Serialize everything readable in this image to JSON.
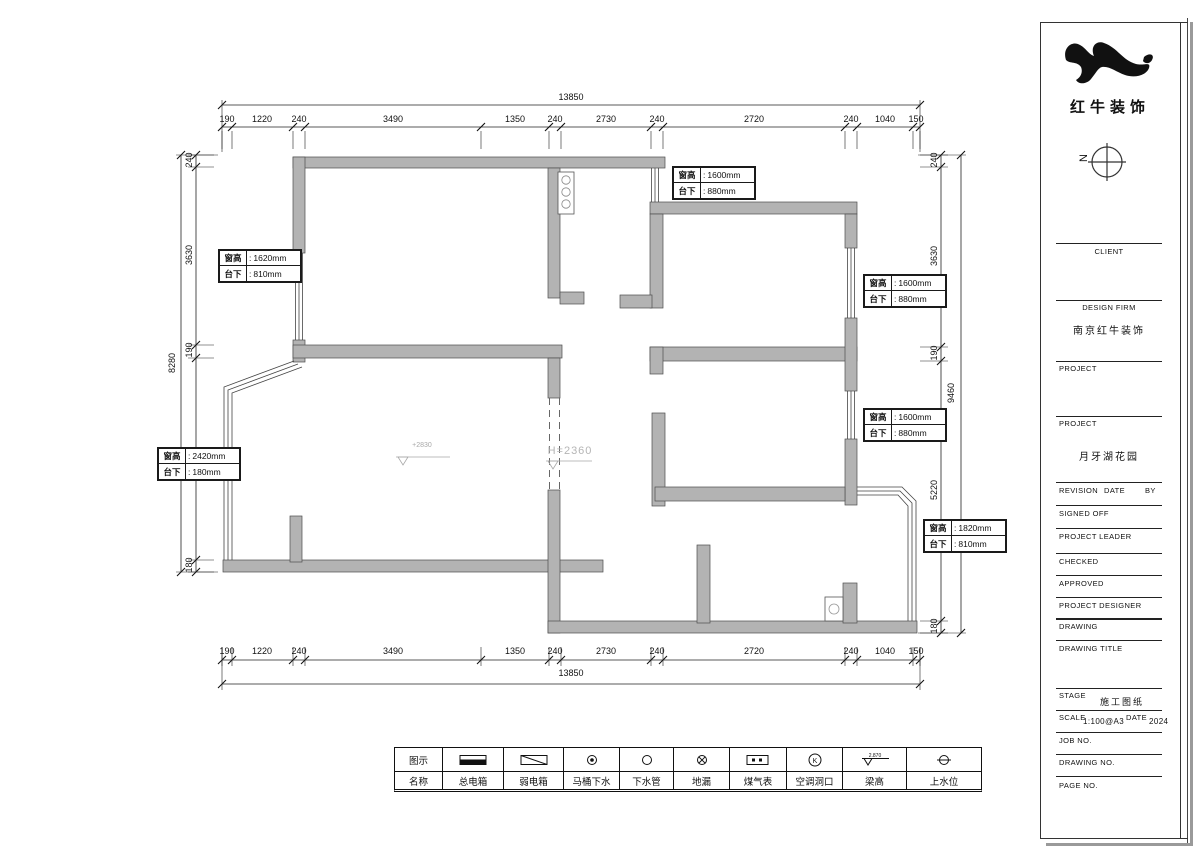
{
  "meta": {
    "colon": ":",
    "wall_color": "#b3b3b3",
    "line_color": "#1a1a1a",
    "muted_color": "#a8a8a8"
  },
  "logo": {
    "company_name": "红牛装饰"
  },
  "north_label": "N",
  "plan": {
    "elevation_label": "+2830",
    "opening_height_label": "H=2360"
  },
  "window_tags": [
    {
      "r1_label": "窗高",
      "r1_value": "1620mm",
      "r2_label": "台下",
      "r2_value": "810mm"
    },
    {
      "r1_label": "窗高",
      "r1_value": "1600mm",
      "r2_label": "台下",
      "r2_value": "880mm"
    },
    {
      "r1_label": "窗高",
      "r1_value": "1600mm",
      "r2_label": "台下",
      "r2_value": "880mm"
    },
    {
      "r1_label": "窗高",
      "r1_value": "1600mm",
      "r2_label": "台下",
      "r2_value": "880mm"
    },
    {
      "r1_label": "窗高",
      "r1_value": "2420mm",
      "r2_label": "台下",
      "r2_value": "180mm"
    },
    {
      "r1_label": "窗高",
      "r1_value": "1820mm",
      "r2_label": "台下",
      "r2_value": "810mm"
    }
  ],
  "dimensions": {
    "top": {
      "total": "13850",
      "segments": [
        "190",
        "1220",
        "240",
        "3490",
        "1350",
        "240",
        "2730",
        "240",
        "2720",
        "240",
        "1040",
        "150"
      ]
    },
    "bottom": {
      "total": "13850",
      "segments": [
        "190",
        "1220",
        "240",
        "3490",
        "1350",
        "240",
        "2730",
        "240",
        "2720",
        "240",
        "1040",
        "150"
      ]
    },
    "left": {
      "total": "8280",
      "segments": [
        "240",
        "3630",
        "190",
        "4040",
        "180"
      ]
    },
    "right": {
      "total": "9460",
      "segments": [
        "240",
        "3630",
        "190",
        "5220",
        "180"
      ]
    }
  },
  "legend": {
    "symbol_header": "图示",
    "name_header": "名称",
    "items": [
      {
        "name": "总电箱",
        "symbol": "main-electric-box"
      },
      {
        "name": "弱电箱",
        "symbol": "weak-electric-box"
      },
      {
        "name": "马桶下水",
        "symbol": "toilet-drain"
      },
      {
        "name": "下水管",
        "symbol": "drain-pipe"
      },
      {
        "name": "地漏",
        "symbol": "floor-drain"
      },
      {
        "name": "煤气表",
        "symbol": "gas-meter"
      },
      {
        "name": "空调洞口",
        "symbol": "ac-opening",
        "text": "K"
      },
      {
        "name": "梁高",
        "symbol": "beam-height",
        "text": "2.870"
      },
      {
        "name": "上水位",
        "symbol": "water-supply-level"
      }
    ]
  },
  "title_block": {
    "client_label": "CLIENT",
    "design_firm_label": "DESIGN  FIRM",
    "design_firm_value": "南京红牛装饰",
    "project1_label": "PROJECT",
    "project2_label": "PROJECT",
    "project_value": "月牙湖花园",
    "revision_label": "REVISION",
    "date_label": "DATE",
    "by_label": "BY",
    "signed_off_label": "SIGNED  OFF",
    "project_leader_label": "PROJECT  LEADER",
    "checked_label": "CHECKED",
    "approved_label": "APPROVED",
    "project_designer_label": "PROJECT  DESIGNER",
    "drawing_label": "DRAWING",
    "drawing_title_label": "DRAWING  TITLE",
    "stage_label": "STAGE",
    "stage_value": "施工图纸",
    "scale_label": "SCALE",
    "scale_value": "1:100@A3",
    "date2_label": "DATE",
    "date_value": "2024",
    "job_no_label": "JOB  NO.",
    "drawing_no_label": "DRAWING  NO.",
    "page_no_label": "PAGE  NO."
  }
}
